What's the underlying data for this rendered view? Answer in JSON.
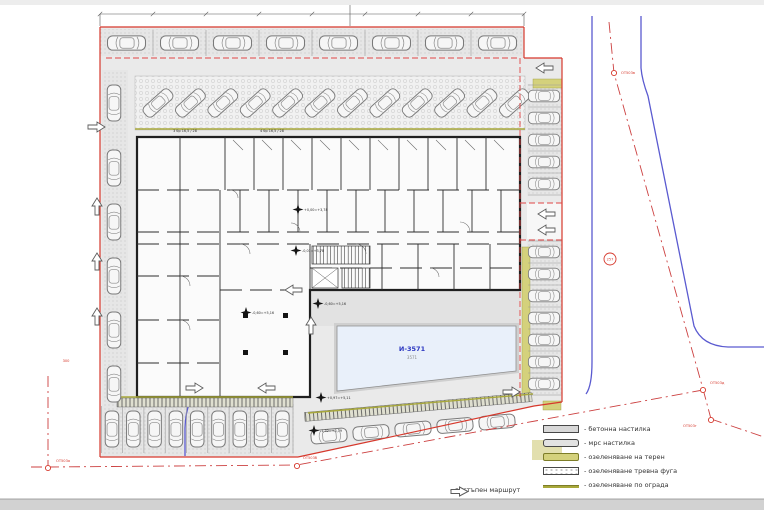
{
  "legend": {
    "items": [
      {
        "key": "concrete",
        "label": "- бетонна настилка"
      },
      {
        "key": "paver",
        "label": "- мрс настилка"
      },
      {
        "key": "green-terrain",
        "label": "- озеленяване на терен"
      },
      {
        "key": "green-joint",
        "label": "- озеленяване тревна фуга"
      },
      {
        "key": "green-fence",
        "label": "- озеленяване по ограда"
      }
    ],
    "route": {
      "label": "- достъпен маршрут"
    }
  },
  "plan": {
    "pool": {
      "id": "И-3571",
      "sub": "3571"
    },
    "stair_notes": [
      {
        "x": 185,
        "y": 132,
        "t": "3 бр 16,5 / 28"
      },
      {
        "x": 272,
        "y": 132,
        "t": "4 бр 16,5 / 28"
      }
    ],
    "elevations": [
      {
        "x": 304,
        "y": 211,
        "t": "+0,00=+3,78"
      },
      {
        "x": 302,
        "y": 252,
        "t": "-0,01=+3,78"
      },
      {
        "x": 252,
        "y": 314,
        "t": "-0,60=+5,16"
      },
      {
        "x": 324,
        "y": 305,
        "t": "-0,60=+5,16"
      },
      {
        "x": 327,
        "y": 399,
        "t": "+0,97=+5,11"
      },
      {
        "x": 320,
        "y": 432,
        "t": "-1,32=+3,79"
      }
    ],
    "survey_points": [
      {
        "x": 48,
        "y": 468,
        "t": "ОТ503а",
        "lx": 56,
        "ly": 462
      },
      {
        "x": 297,
        "y": 466,
        "t": "ОТ503б",
        "lx": 303,
        "ly": 459
      },
      {
        "x": 614,
        "y": 73,
        "t": "ОТ503в",
        "lx": 621,
        "ly": 74
      },
      {
        "x": 703,
        "y": 390,
        "t": "ОТ503д",
        "lx": 710,
        "ly": 384
      },
      {
        "x": 711,
        "y": 420,
        "t": "ОТ503г",
        "lx": 683,
        "ly": 427
      }
    ],
    "point_circle": {
      "x": 610,
      "y": 259,
      "t": "257"
    },
    "dim_note": {
      "x": 66,
      "y": 362,
      "t": "300"
    }
  },
  "parking": {
    "groups": [
      {
        "id": "top-row",
        "count": 8,
        "orientation": "horizontal"
      },
      {
        "id": "diagonal-row",
        "count": 12,
        "orientation": "diagonal"
      },
      {
        "id": "left-column",
        "count": 6,
        "orientation": "vertical"
      },
      {
        "id": "right-column-upper",
        "count": 5,
        "orientation": "horizontal"
      },
      {
        "id": "right-column-lower",
        "count": 7,
        "orientation": "horizontal"
      },
      {
        "id": "bottom-row",
        "count": 9,
        "orientation": "vertical"
      },
      {
        "id": "bottom-diagonal",
        "count": 5,
        "orientation": "inclined"
      }
    ]
  },
  "colors": {
    "boundary_red": "#d6382c",
    "regulation_red": "#e04545",
    "road_blue": "#5a5ad0",
    "green_olive": "#d4d17c",
    "pool_text_blue": "#2a35c0"
  }
}
